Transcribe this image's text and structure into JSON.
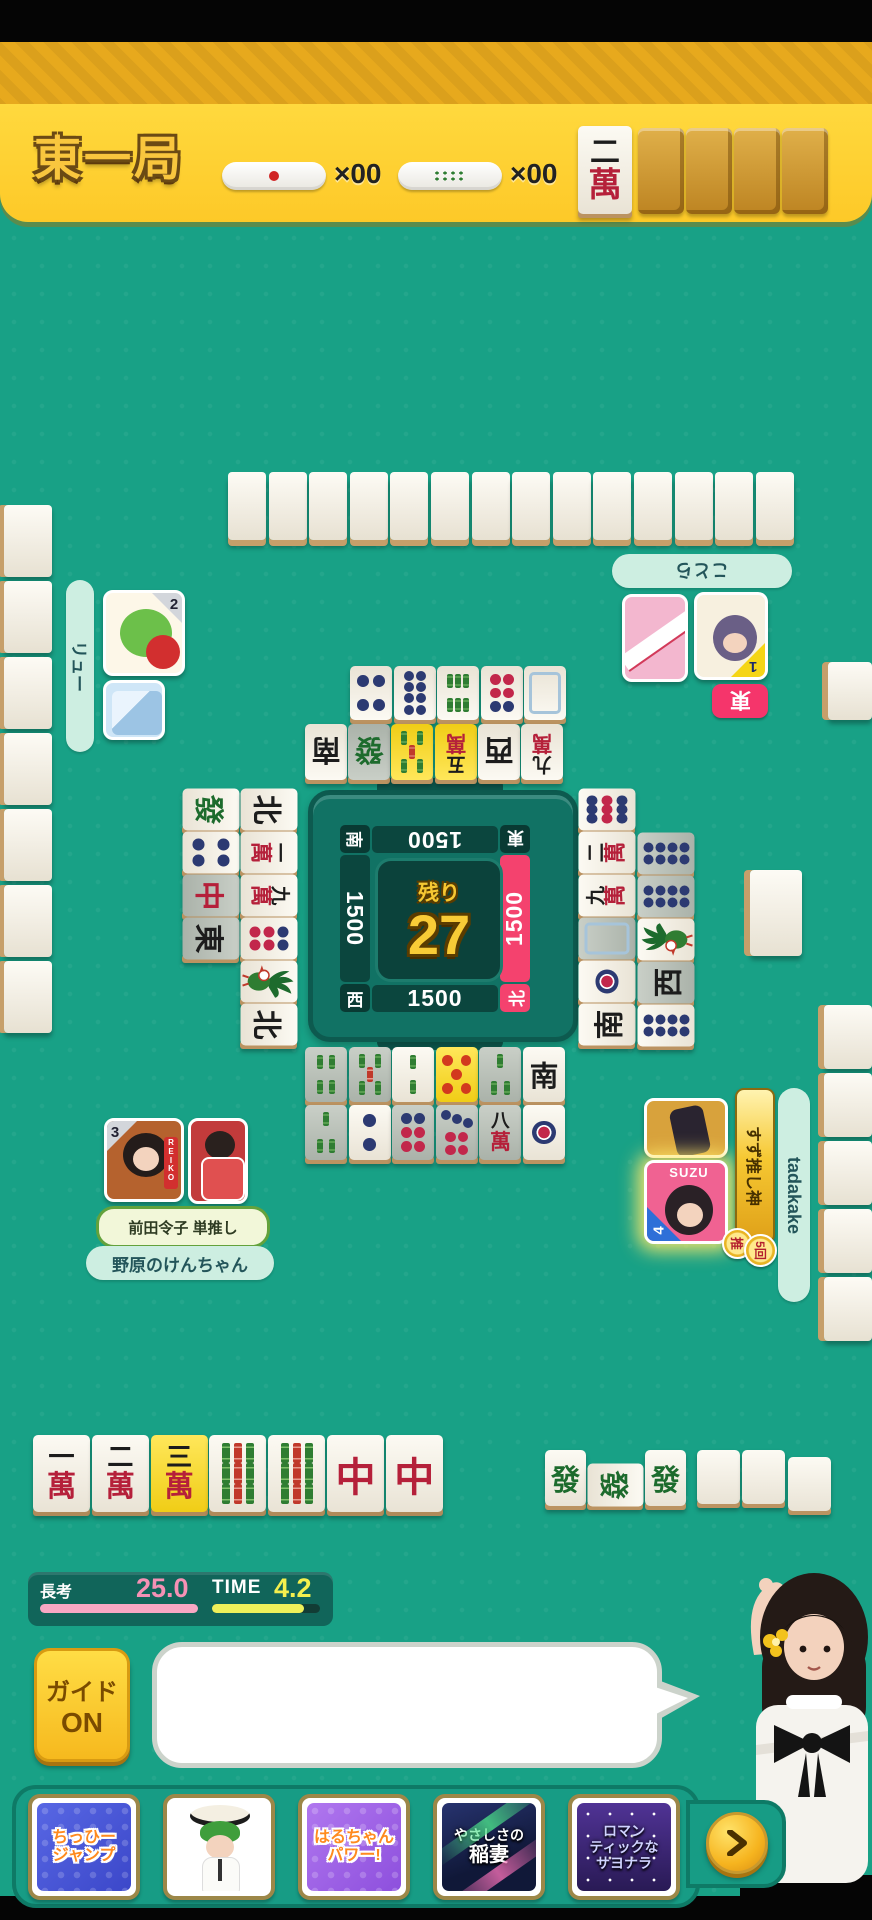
{
  "header": {
    "round_label": "東一局",
    "stick_counters": [
      {
        "icon": "thousand-point-stick-icon",
        "count_label": "×00"
      },
      {
        "icon": "hundred-point-stick-icon",
        "count_label": "×00"
      }
    ],
    "dora_indicator_tile": "2m",
    "facedown_tile_count": 4
  },
  "center_panel": {
    "remaining_label": "残り",
    "remaining_count": "27",
    "seats": [
      {
        "pos": "top",
        "wind": "東",
        "score": "1500",
        "active": false
      },
      {
        "pos": "right",
        "wind": "北",
        "score": "1500",
        "active": true
      },
      {
        "pos": "bottom",
        "wind": "西",
        "score": "1500",
        "active": false
      },
      {
        "pos": "left",
        "wind": "南",
        "score": "1500",
        "active": false
      }
    ]
  },
  "players": {
    "top": {
      "name": "ことら",
      "order_badge": "1",
      "seat_badge": "東"
    },
    "left": {
      "name": "リュー",
      "order_badge": "2"
    },
    "bottom": {
      "name": "野原のけんちゃん",
      "order_badge": "3",
      "oshi_label": "前田令子 単推し"
    },
    "right": {
      "name": "tadakake",
      "order_badge": "4",
      "oshi_banner": "すず推し神",
      "oshi_badge": "推",
      "skill_count_badge": "5回",
      "avatar_caption": "SUZU"
    }
  },
  "tiles": {
    "hand": [
      {
        "c": "1m"
      },
      {
        "c": "2m"
      },
      {
        "c": "3m",
        "hl": true
      },
      {
        "c": "9s"
      },
      {
        "c": "9s"
      },
      {
        "c": "C"
      },
      {
        "c": "C"
      }
    ],
    "meld": [
      {
        "c": "F"
      },
      {
        "c": "F",
        "rot": true
      },
      {
        "c": "F"
      }
    ],
    "blank_slot_count": 3,
    "discards": {
      "top_far": [
        {
          "c": "4p"
        },
        {
          "c": "8p"
        },
        {
          "c": "6s"
        },
        {
          "c": "6p"
        },
        {
          "c": "H"
        }
      ],
      "top_near": [
        {
          "c": "S"
        },
        {
          "c": "F",
          "dim": true
        },
        {
          "c": "5s",
          "hl": true
        },
        {
          "c": "5m",
          "hl": true
        },
        {
          "c": "W"
        },
        {
          "c": "9m"
        }
      ],
      "left_outer": [
        {
          "c": "F"
        },
        {
          "c": "4p"
        },
        {
          "c": "C",
          "dim": true
        },
        {
          "c": "E",
          "dim": true
        }
      ],
      "left_inner": [
        {
          "c": "N"
        },
        {
          "c": "1m"
        },
        {
          "c": "9m"
        },
        {
          "c": "6p"
        },
        {
          "c": "1s"
        },
        {
          "c": "N"
        }
      ],
      "right_inner": [
        {
          "c": "9p"
        },
        {
          "c": "2m"
        },
        {
          "c": "9m"
        },
        {
          "c": "H",
          "dim": true
        },
        {
          "c": "1p"
        },
        {
          "c": "S"
        }
      ],
      "right_outer": [
        {
          "c": "8p",
          "dim": true
        },
        {
          "c": "8p",
          "dim": true
        },
        {
          "c": "1s"
        },
        {
          "c": "W",
          "dim": true
        },
        {
          "c": "8p"
        }
      ],
      "bottom_row1": [
        {
          "c": "4s",
          "dim": true
        },
        {
          "c": "5s",
          "dim": true
        },
        {
          "c": "2s"
        },
        {
          "c": "5p",
          "hl": true
        },
        {
          "c": "3s",
          "dim": true
        },
        {
          "c": "S"
        }
      ],
      "bottom_row2": [
        {
          "c": "3s",
          "dim": true
        },
        {
          "c": "2p"
        },
        {
          "c": "6p",
          "dim": true
        },
        {
          "c": "7p",
          "dim": true
        },
        {
          "c": "8m",
          "dim": true
        },
        {
          "c": "1p"
        }
      ]
    },
    "walls": {
      "top_count": 14,
      "left_count": 7,
      "right_count": 5
    }
  },
  "timer": {
    "thinking_label": "長考",
    "thinking_value": "25.0",
    "time_label": "TIME",
    "time_value": "4.2"
  },
  "guide_button": {
    "line1": "ガイド",
    "line2": "ON"
  },
  "speech_bubble": {
    "text": ""
  },
  "skill_cards": [
    {
      "lines": [
        "ちっひー",
        "ジャンプ"
      ]
    },
    {
      "lines": [],
      "icon": "bowing-character"
    },
    {
      "lines": [
        "はるちゃん",
        "パワー!"
      ]
    },
    {
      "lines": [
        "やさしさの",
        "稲妻"
      ]
    },
    {
      "lines": [
        "ロマン",
        "ティックな",
        "サヨナラ"
      ]
    }
  ],
  "colors": {
    "felt": "#18a186",
    "header_yellow": "#fdc928",
    "active_pink": "#f4426e",
    "panel_teal": "#117264",
    "gold": "#f6c832",
    "mint_pill": "#cdeee1",
    "highlight_tile": "#f0cd16",
    "timer_pink": "#f7a8c3",
    "timer_yellow": "#eef05a"
  }
}
